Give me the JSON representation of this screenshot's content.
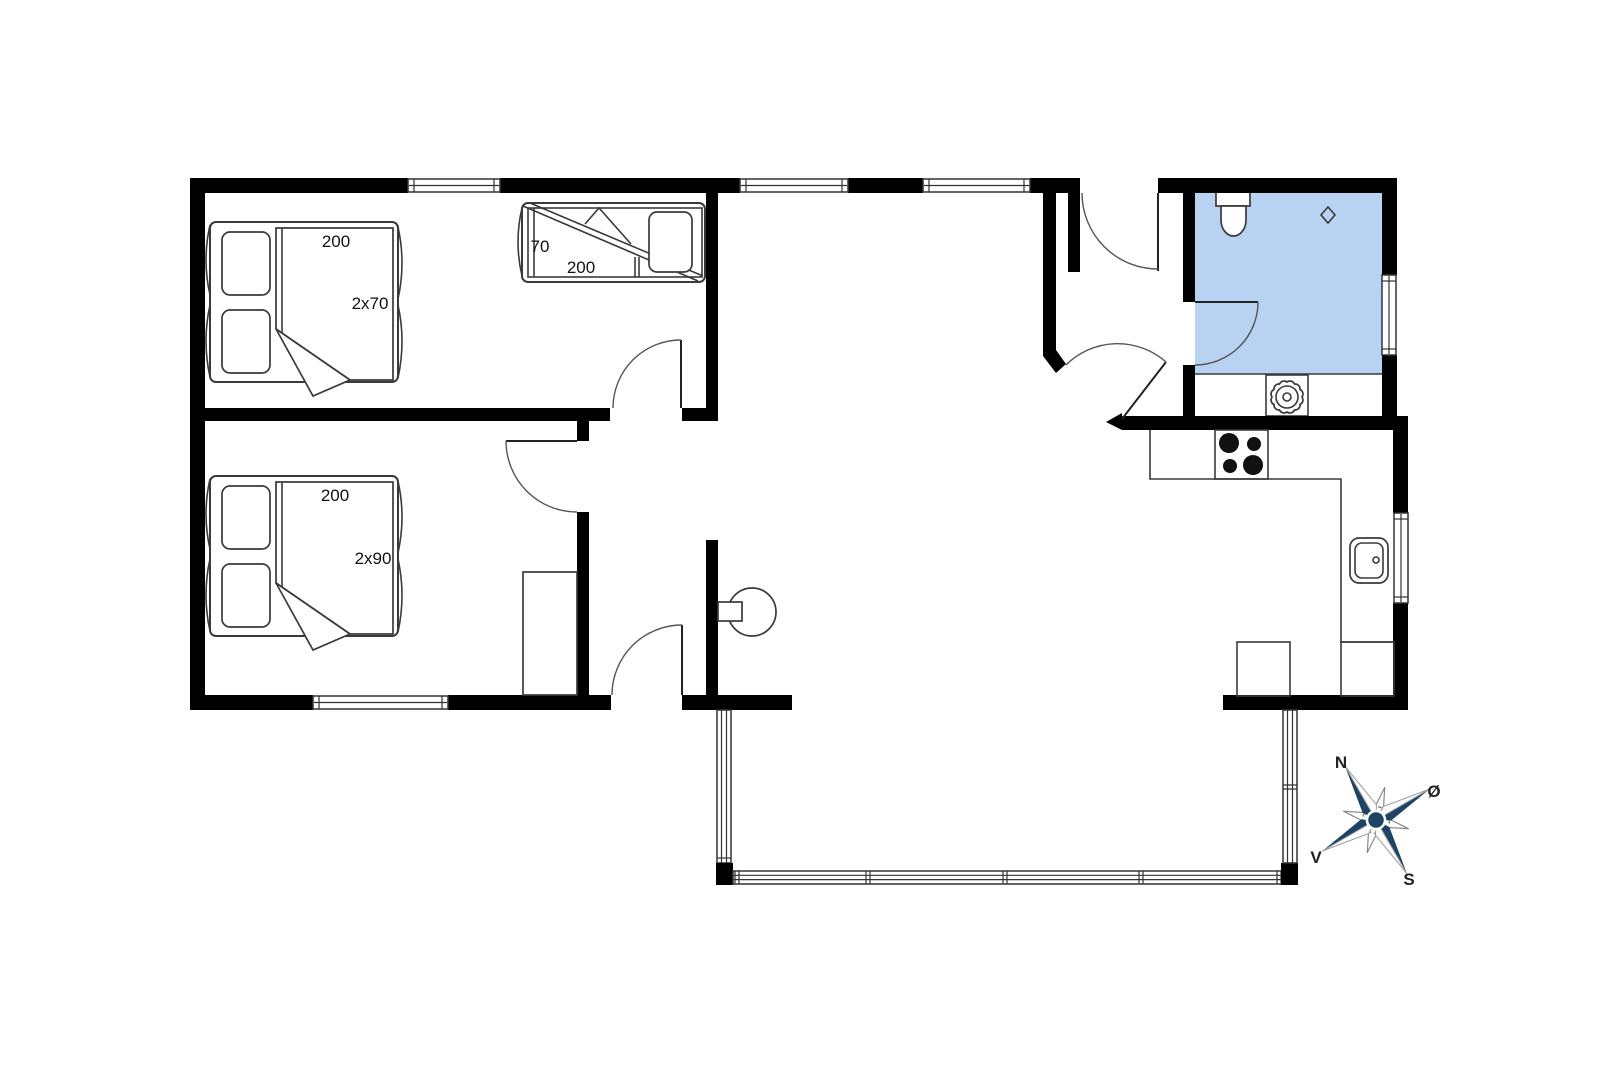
{
  "title": "Floor plan",
  "labels": {
    "bed1_length": "200",
    "bed1_width": "2x70",
    "bunk_width": "70",
    "bunk_length": "200",
    "bed2_length": "200",
    "bed2_width": "2x90"
  },
  "compass": {
    "north": "N",
    "east": "Ø",
    "west": "V",
    "south": "S"
  },
  "colors": {
    "bathroom_floor": "#b8d2f1",
    "compass_blue": "#1d4365",
    "walls": "#000000",
    "lines": "#333333"
  }
}
